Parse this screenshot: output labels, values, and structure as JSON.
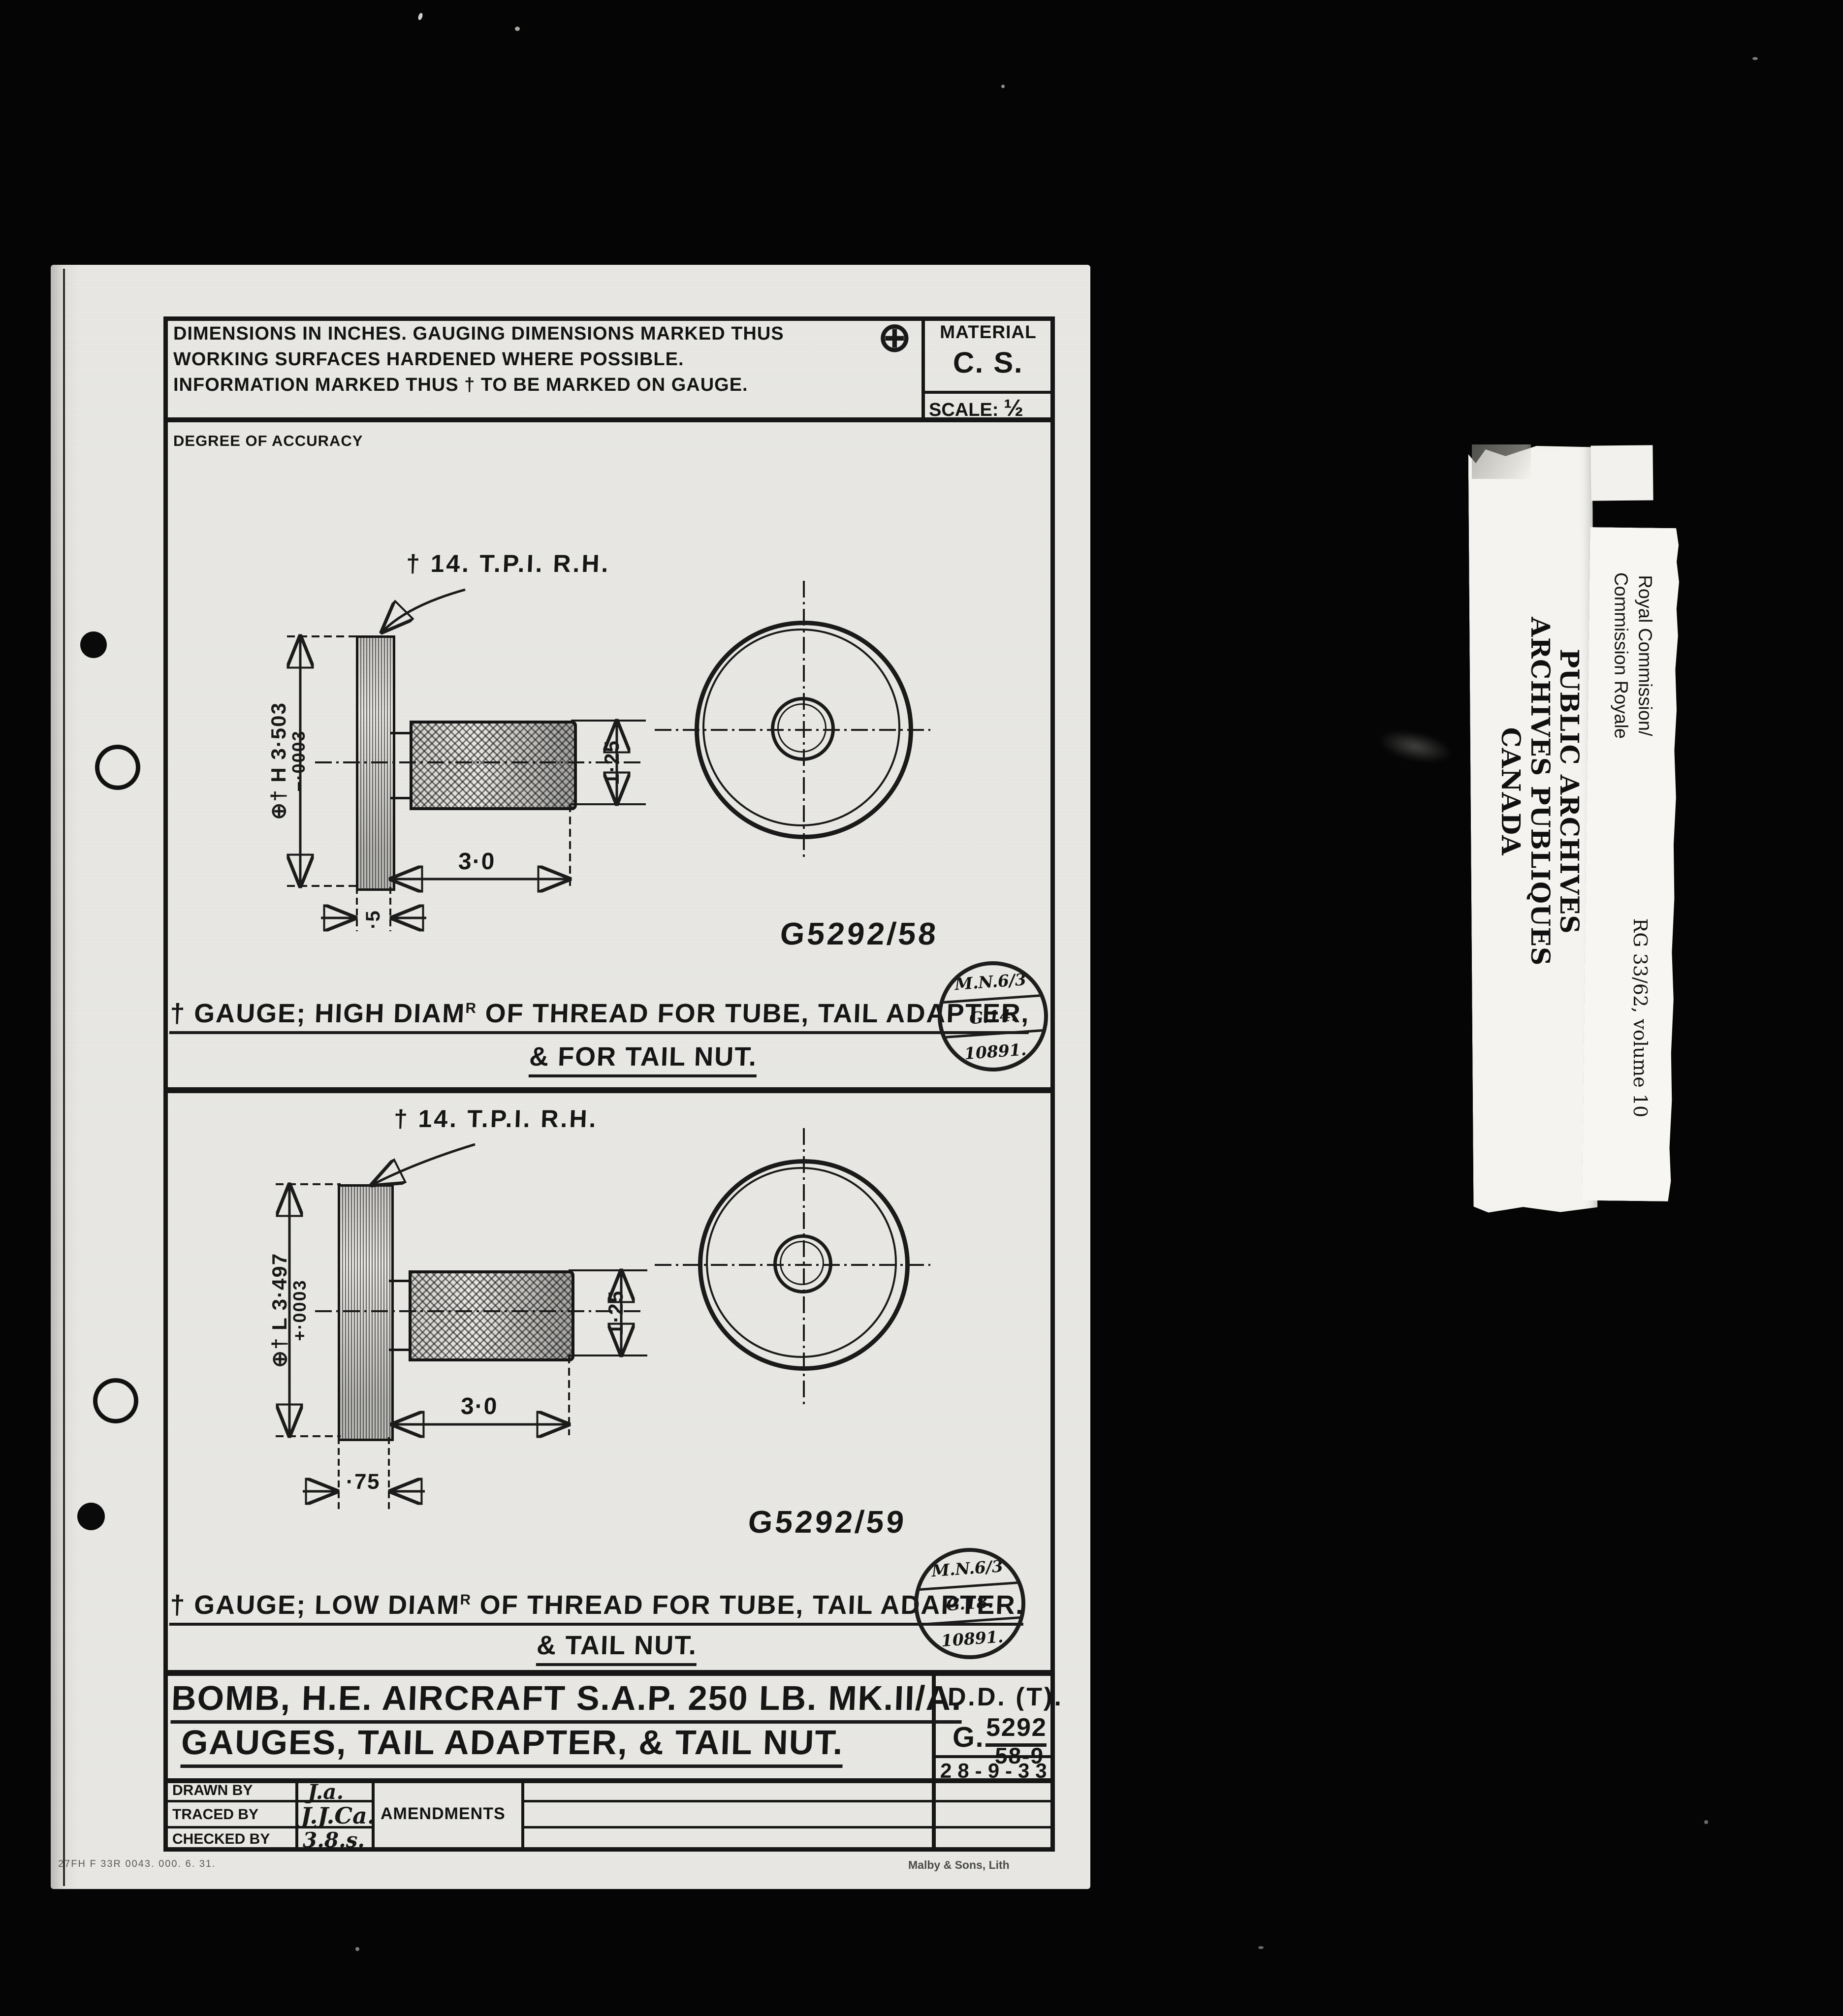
{
  "header": {
    "note_line1": "DIMENSIONS IN INCHES. GAUGING DIMENSIONS MARKED THUS",
    "gauging_symbol": "⊕",
    "note_line2": "WORKING SURFACES HARDENED WHERE POSSIBLE.",
    "note_line3": "INFORMATION MARKED THUS † TO BE MARKED ON GAUGE.",
    "material_label": "MATERIAL",
    "material_value": "C. S.",
    "scale_label": "SCALE:",
    "scale_value": "½",
    "accuracy_label": "DEGREE OF ACCURACY"
  },
  "drawing1": {
    "part_no": "G5292/58",
    "thread_note": "† 14. T.P.I.  R.H.",
    "diameter_dim": "⊕† H 3·503",
    "diameter_tolerance": "−·0003",
    "handle_diameter": "1·25",
    "handle_length": "3·0",
    "disc_thickness": "·5",
    "caption_pre": "† GAUGE; HIGH DIAM",
    "caption_sup": "R",
    "caption_post": " OF THREAD FOR TUBE, TAIL ADAPTER,",
    "caption_line2": "& FOR TAIL NUT.",
    "stamp_line1": "M.N.6/3",
    "stamp_line2": "G.14.",
    "stamp_line3": "10891."
  },
  "drawing2": {
    "part_no": "G5292/59",
    "thread_note": "† 14. T.P.I.  R.H.",
    "diameter_dim": "⊕† L 3·497",
    "diameter_tolerance": "+·0003",
    "handle_diameter": "1·25",
    "handle_length": "3·0",
    "disc_thickness": "·75",
    "caption_pre": "† GAUGE; LOW DIAM",
    "caption_sup": "R",
    "caption_post": " OF THREAD FOR TUBE, TAIL ADAPTER.",
    "caption_line2": "& TAIL NUT.",
    "stamp_line1": "M.N.6/3",
    "stamp_line2": "G.18.",
    "stamp_line3": "10891."
  },
  "title_block": {
    "title_line1": "BOMB, H.E. AIRCRAFT S.A.P. 250 LB. MK.II/A.",
    "title_line2": "GAUGES, TAIL ADAPTER, & TAIL NUT.",
    "dept": "D.D. (T).",
    "ref_prefix": "G.",
    "ref_numerator": "5292",
    "ref_denominator": "58-9",
    "date": "28-9-33",
    "drawn_label": "DRAWN BY",
    "drawn_sig": "J.a.",
    "traced_label": "TRACED BY",
    "traced_sig": "J.J.Ca.",
    "checked_label": "CHECKED BY",
    "checked_sig": "3.8.s.",
    "amendments_label": "AMENDMENTS",
    "print_code": "27FH F 33R 0043. 000. 6. 31.",
    "printer_credit": "Malby & Sons, Lith"
  },
  "archive_labels": {
    "sticker_line1": "PUBLIC ARCHIVES",
    "sticker_line2": "ARCHIVES PUBLIQUES",
    "sticker_line3": "CANADA",
    "card_line1": "Royal Commission/",
    "card_line2": "Commission Royale",
    "card_ref": "RG 33/62, volume 10"
  },
  "colors": {
    "film_background": "#050505",
    "page": "#e9e8e4",
    "ink": "#191919",
    "sticker": "#f4f3ef",
    "card": "#f7f6f2"
  }
}
